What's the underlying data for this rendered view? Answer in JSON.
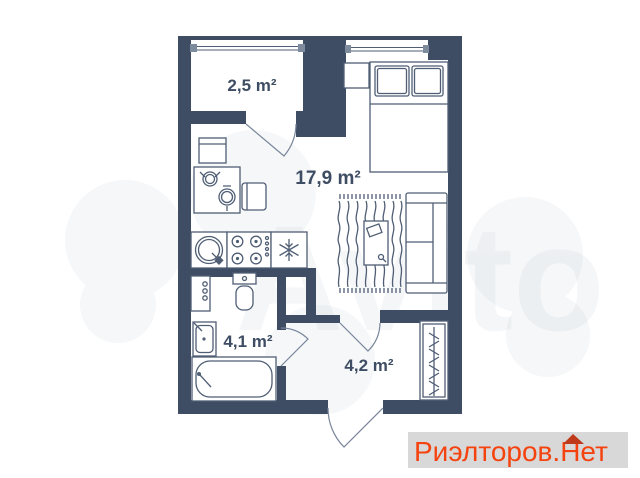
{
  "floorplan": {
    "rooms": [
      {
        "id": "balcony",
        "area_label": "2,5 m²"
      },
      {
        "id": "living-room",
        "area_label": "17,9 m²"
      },
      {
        "id": "bathroom",
        "area_label": "4,1 m²"
      },
      {
        "id": "hallway",
        "area_label": "4,2 m²"
      }
    ],
    "colors": {
      "walls": "#3e4d63",
      "furniture": "#4f5e74",
      "background": "#ffffff"
    }
  },
  "watermark": {
    "text": "Avito"
  },
  "branding": {
    "site_name": "Риэлторов.Нет",
    "text_color": "#f5430f",
    "roof_color": "#bf3a1b",
    "background_color": "#d8d8d8"
  }
}
